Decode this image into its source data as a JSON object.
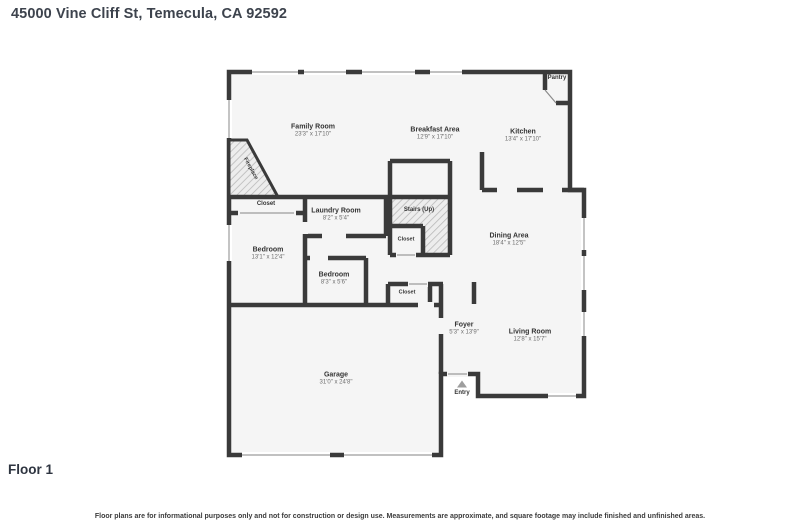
{
  "page": {
    "title": "45000 Vine Cliff St, Temecula, CA 92592",
    "floor_label": "Floor 1",
    "disclaimer": "Floor plans are for informational purposes only and not for construction or design use. Measurements are approximate, and square footage may include finished and unfinished areas."
  },
  "colors": {
    "wall": "#3a3a3a",
    "room_fill": "#f5f5f5",
    "hatch_line": "#b9b9b9",
    "window_frame": "#9c9c9c",
    "entry_arrow": "#9e9e9e",
    "title_text": "#3d434d"
  },
  "rooms": {
    "family_room": {
      "name": "Family Room",
      "dims": "23'3\" x 17'10\""
    },
    "breakfast_area": {
      "name": "Breakfast Area",
      "dims": "12'9\" x 17'10\""
    },
    "kitchen": {
      "name": "Kitchen",
      "dims": "13'4\" x 17'10\""
    },
    "pantry": {
      "name": "Pantry"
    },
    "fireplace": {
      "name": "Fireplace"
    },
    "closet_top": {
      "name": "Closet"
    },
    "laundry_room": {
      "name": "Laundry Room",
      "dims": "8'2\" x 5'4\""
    },
    "stairs": {
      "name": "Stairs (Up)"
    },
    "stairs_closet": {
      "name": "Closet"
    },
    "bedroom_left": {
      "name": "Bedroom",
      "dims": "13'1\" x 12'4\""
    },
    "bedroom_small": {
      "name": "Bedroom",
      "dims": "8'3\" x 5'6\""
    },
    "dining_area": {
      "name": "Dining Area",
      "dims": "18'4\" x 12'5\""
    },
    "closet_center": {
      "name": "Closet"
    },
    "foyer": {
      "name": "Foyer",
      "dims": "5'3\" x 13'9\""
    },
    "living_room": {
      "name": "Living Room",
      "dims": "12'8\" x 15'7\""
    },
    "garage": {
      "name": "Garage",
      "dims": "31'0\" x 24'8\""
    },
    "entry": {
      "name": "Entry"
    }
  }
}
